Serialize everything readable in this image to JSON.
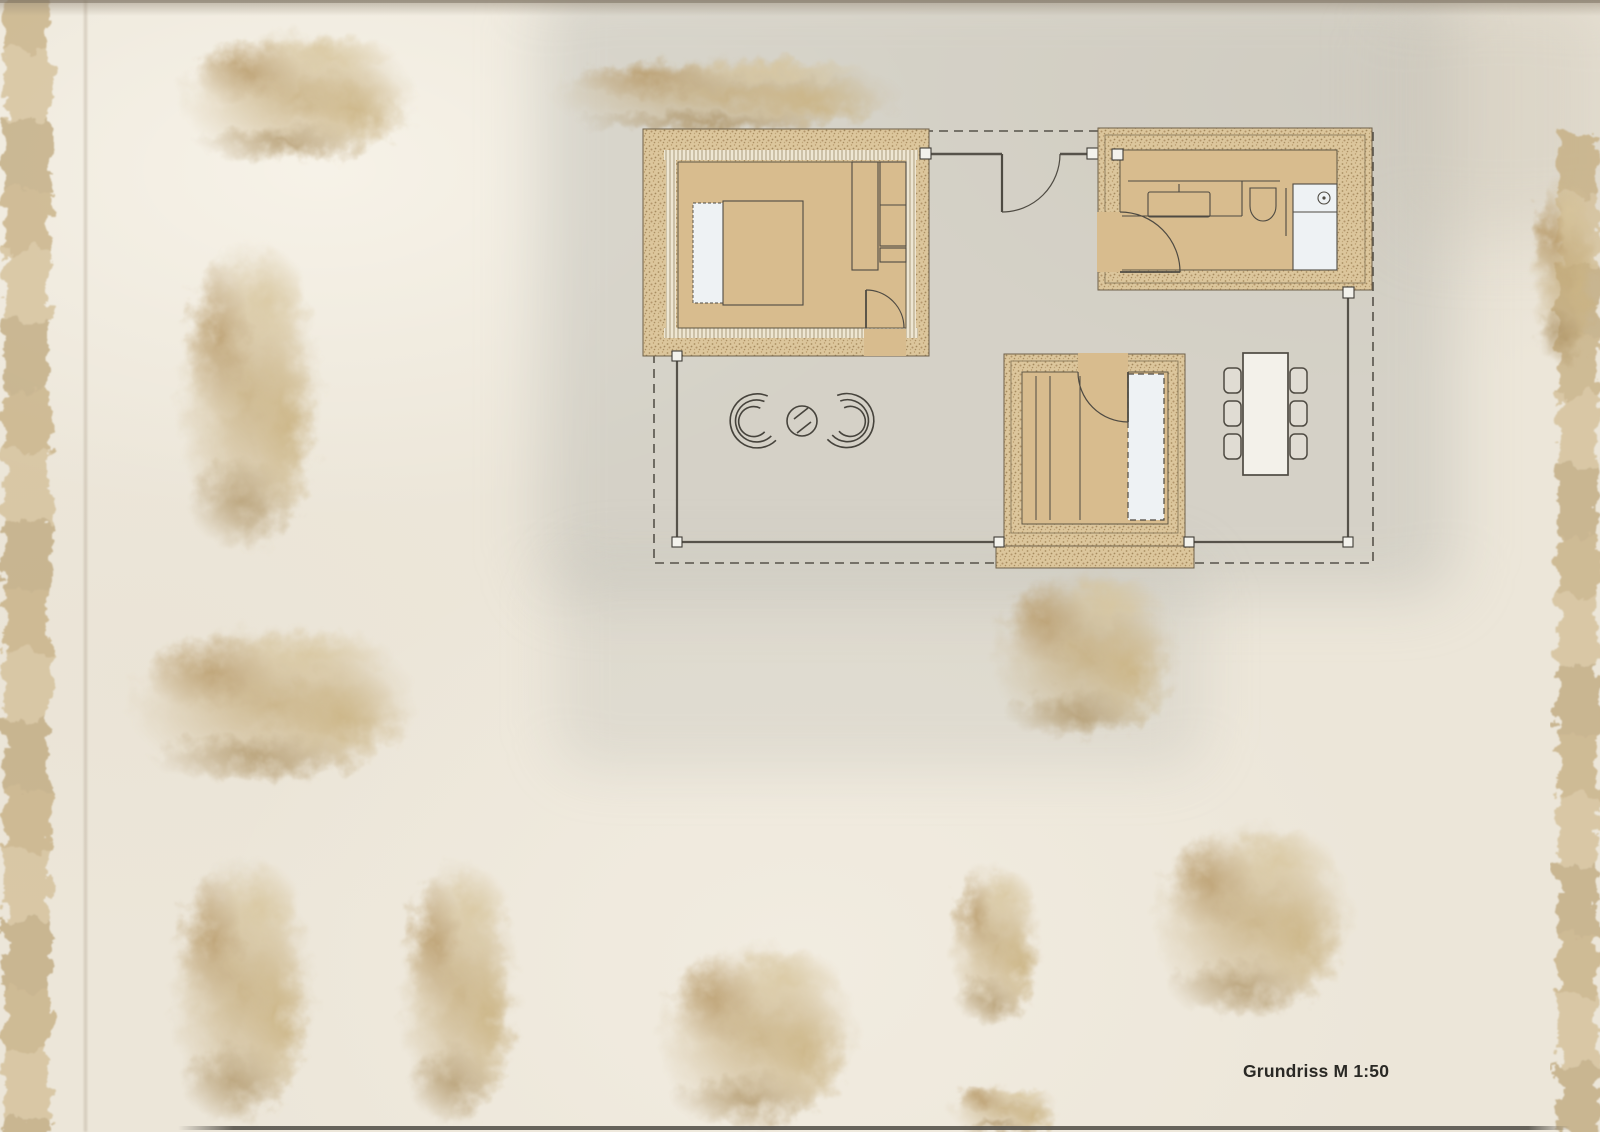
{
  "plan": {
    "label": "Grundriss M 1:50"
  },
  "palette": {
    "paper": "#ece6d9",
    "wall_stipple": "#dcc69c",
    "room_floor": "#d8bc8e",
    "linework": "#4e4a42",
    "fixtures_white": "#eef2f4",
    "vegetation": "#c6ac7e",
    "label_text": "#2a2925"
  }
}
